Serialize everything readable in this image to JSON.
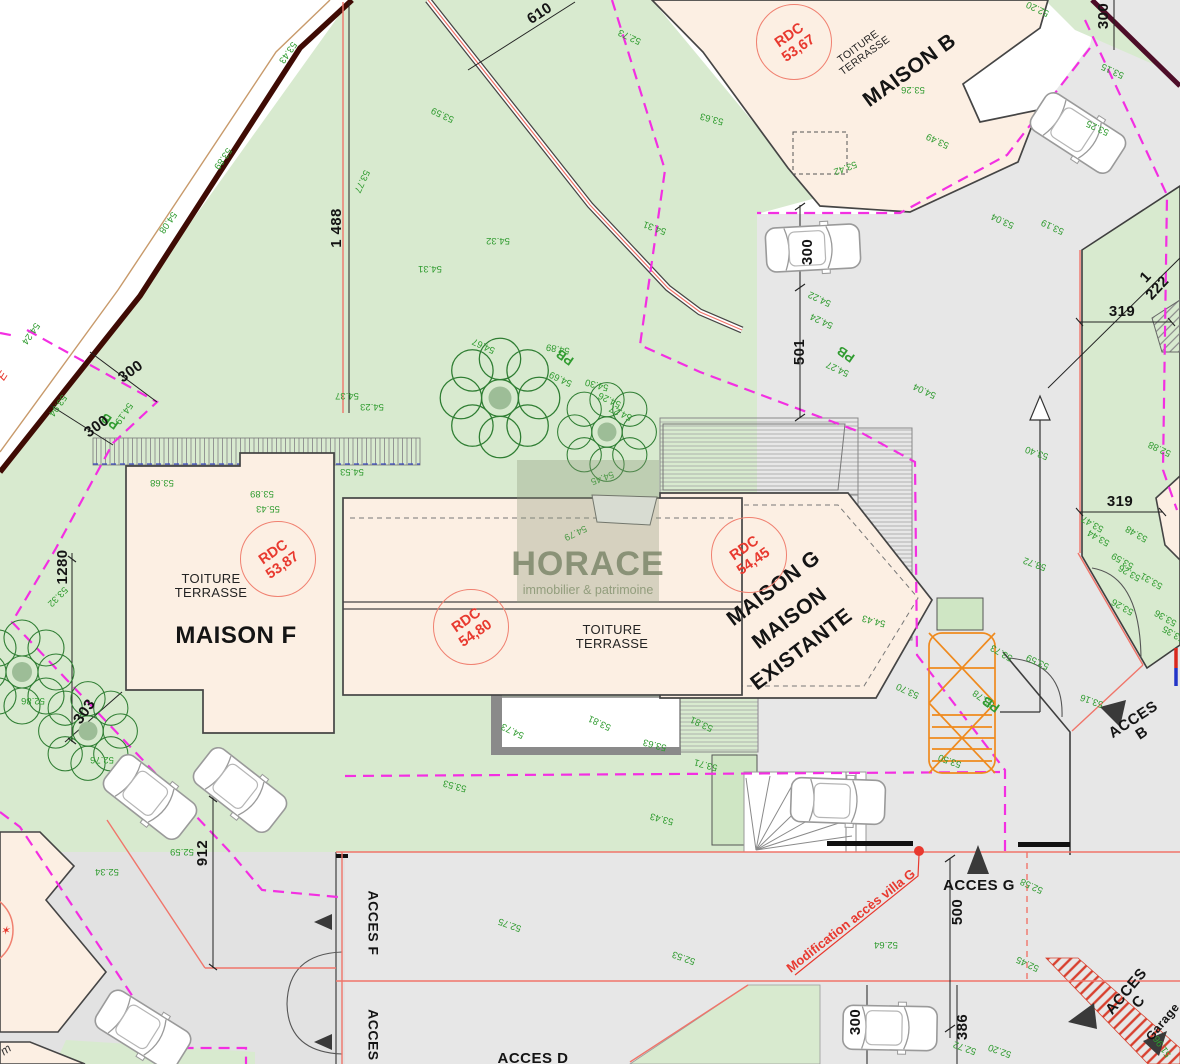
{
  "watermark": {
    "name": "HORACE",
    "tagline": "immobilier & patrimoine"
  },
  "colors": {
    "accent_red": "#e8392f",
    "elevation_green": "#2f9b2f",
    "limit_magenta": "#f32fe2",
    "boundary_dark": "#3f0b04",
    "watermark_olive": "#8d987c",
    "vehicle_orange": "#ef8a1e",
    "area_green": "#d8eacf",
    "area_gray": "#e7e7e7",
    "building_cream": "#fcefe3"
  },
  "buildings": [
    {
      "id": "maison-b",
      "label": "MAISON B",
      "roof": "TOITURE TERRASSE",
      "rdc": "53,67"
    },
    {
      "id": "maison-f",
      "label": "MAISON F",
      "roof": "TOITURE TERRASSE",
      "rdc": "53,87"
    },
    {
      "id": "maison-centre",
      "label": "",
      "roof": "TOITURE TERRASSE",
      "rdc": "54,80"
    },
    {
      "id": "maison-g",
      "label": "MAISON G MAISON EXISTANTE",
      "rdc": "54,45"
    }
  ],
  "annotations": {
    "rdc_circles": [
      {
        "label": "RDC",
        "value": "53,67",
        "x": 793,
        "y": 41
      },
      {
        "label": "RDC",
        "value": "53,87",
        "x": 277,
        "y": 558
      },
      {
        "label": "RDC",
        "value": "54,80",
        "x": 470,
        "y": 626
      },
      {
        "label": "RDC",
        "value": "54,45",
        "x": 748,
        "y": 554
      }
    ],
    "building_labels": [
      {
        "t": "MAISON B",
        "x": 910,
        "y": 71,
        "r": -36,
        "s": 21
      },
      {
        "t": "MAISON F",
        "x": 236,
        "y": 636,
        "r": 0,
        "s": 24
      },
      {
        "t": "MAISON G",
        "x": 774,
        "y": 589,
        "r": -37,
        "s": 21
      },
      {
        "t": "MAISON",
        "x": 790,
        "y": 619,
        "r": -37,
        "s": 21
      },
      {
        "t": "EXISTANTE",
        "x": 802,
        "y": 650,
        "r": -37,
        "s": 21
      }
    ],
    "roof_labels": [
      {
        "t": "TOITURE\nTERRASSE",
        "x": 862,
        "y": 52,
        "r": -36,
        "s": 10.5
      },
      {
        "t": "TOITURE\nTERRASSE",
        "x": 211,
        "y": 586,
        "r": 0,
        "s": 13
      },
      {
        "t": "TOITURE\nTERRASSE",
        "x": 612,
        "y": 637,
        "r": 0,
        "s": 13
      }
    ],
    "access_labels": [
      {
        "t": "ACCES F",
        "x": 373,
        "y": 923,
        "r": 90,
        "s": 14
      },
      {
        "t": "ACCES E",
        "x": 373,
        "y": 1042,
        "r": 90,
        "s": 14
      },
      {
        "t": "ACCES G",
        "x": 979,
        "y": 886,
        "r": 0,
        "s": 15
      },
      {
        "t": "ACCES B",
        "x": 1138,
        "y": 727,
        "r": -33,
        "s": 15
      },
      {
        "t": "ACCES C",
        "x": 1133,
        "y": 997,
        "r": -50,
        "s": 15
      },
      {
        "t": "ACCES D",
        "x": 533,
        "y": 1059,
        "r": 0,
        "s": 15
      },
      {
        "t": "Garage",
        "x": 1163,
        "y": 1022,
        "r": -50,
        "s": 12
      }
    ],
    "notes": [
      {
        "t": "Modification accès villa G",
        "x": 851,
        "y": 921,
        "r": -38
      }
    ],
    "dimensions": [
      {
        "t": "610",
        "x": 540,
        "y": 14,
        "r": -33
      },
      {
        "t": "1 488",
        "x": 337,
        "y": 228,
        "r": -90
      },
      {
        "t": "300",
        "x": 131,
        "y": 372,
        "r": -36
      },
      {
        "t": "300",
        "x": 97,
        "y": 427,
        "r": -36
      },
      {
        "t": "1280",
        "x": 63,
        "y": 567,
        "r": -90
      },
      {
        "t": "303",
        "x": 85,
        "y": 712,
        "r": -55
      },
      {
        "t": "912",
        "x": 203,
        "y": 853,
        "r": -90
      },
      {
        "t": "300",
        "x": 808,
        "y": 252,
        "r": -90
      },
      {
        "t": "501",
        "x": 800,
        "y": 352,
        "r": -90
      },
      {
        "t": "300",
        "x": 1104,
        "y": 16,
        "r": -90
      },
      {
        "t": "319",
        "x": 1122,
        "y": 312,
        "r": 0
      },
      {
        "t": "1 222",
        "x": 1152,
        "y": 283,
        "r": -47
      },
      {
        "t": "319",
        "x": 1120,
        "y": 502,
        "r": 0
      },
      {
        "t": "500",
        "x": 958,
        "y": 912,
        "r": -90
      },
      {
        "t": "300",
        "x": 856,
        "y": 1022,
        "r": -90
      },
      {
        "t": "386",
        "x": 963,
        "y": 1027,
        "r": -90
      }
    ],
    "pb_markers": [
      {
        "t": "PB",
        "x": 110,
        "y": 421,
        "r": 215
      },
      {
        "t": "PB",
        "x": 565,
        "y": 357,
        "r": 215
      },
      {
        "t": "PB",
        "x": 846,
        "y": 354,
        "r": 215
      },
      {
        "t": "PB",
        "x": 991,
        "y": 704,
        "r": 215
      }
    ],
    "green_elevations": [
      {
        "t": "52.20",
        "x": 1038,
        "y": 8,
        "r": 205
      },
      {
        "t": "52.73",
        "x": 630,
        "y": 36,
        "r": 205
      },
      {
        "t": "53.15",
        "x": 1113,
        "y": 70,
        "r": 205
      },
      {
        "t": "53.26",
        "x": 913,
        "y": 89,
        "r": 180
      },
      {
        "t": "53.63",
        "x": 712,
        "y": 118,
        "r": 195
      },
      {
        "t": "53.59",
        "x": 443,
        "y": 114,
        "r": 205
      },
      {
        "t": "53.25",
        "x": 1098,
        "y": 127,
        "r": 205
      },
      {
        "t": "53.49",
        "x": 938,
        "y": 140,
        "r": 205
      },
      {
        "t": "53.42",
        "x": 845,
        "y": 167,
        "r": 160
      },
      {
        "t": "53.04",
        "x": 1003,
        "y": 220,
        "r": 205
      },
      {
        "t": "53.19",
        "x": 1053,
        "y": 226,
        "r": 205
      },
      {
        "t": "53.43",
        "x": 287,
        "y": 52,
        "r": 125
      },
      {
        "t": "53.89",
        "x": 222,
        "y": 158,
        "r": 125
      },
      {
        "t": "54.08",
        "x": 167,
        "y": 222,
        "r": 125
      },
      {
        "t": "53.77",
        "x": 361,
        "y": 181,
        "r": 115
      },
      {
        "t": "54.24",
        "x": 30,
        "y": 333,
        "r": 125
      },
      {
        "t": "53.94",
        "x": 57,
        "y": 405,
        "r": 125
      },
      {
        "t": "54.19",
        "x": 123,
        "y": 413,
        "r": 125
      },
      {
        "t": "54.22",
        "x": 820,
        "y": 298,
        "r": 205
      },
      {
        "t": "54.24",
        "x": 822,
        "y": 320,
        "r": 205
      },
      {
        "t": "54.27",
        "x": 838,
        "y": 368,
        "r": 205
      },
      {
        "t": "54.04",
        "x": 925,
        "y": 390,
        "r": 205
      },
      {
        "t": "54.31",
        "x": 430,
        "y": 268,
        "r": 180
      },
      {
        "t": "54.32",
        "x": 498,
        "y": 240,
        "r": 180
      },
      {
        "t": "54.31",
        "x": 655,
        "y": 227,
        "r": 200
      },
      {
        "t": "54.23",
        "x": 372,
        "y": 406,
        "r": 180
      },
      {
        "t": "54.37",
        "x": 347,
        "y": 395,
        "r": 180
      },
      {
        "t": "54.67",
        "x": 484,
        "y": 345,
        "r": 205
      },
      {
        "t": "54.89",
        "x": 558,
        "y": 348,
        "r": 190
      },
      {
        "t": "54.69",
        "x": 561,
        "y": 378,
        "r": 205
      },
      {
        "t": "54.30",
        "x": 597,
        "y": 384,
        "r": 195
      },
      {
        "t": "54.26",
        "x": 610,
        "y": 399,
        "r": 205
      },
      {
        "t": "54.27",
        "x": 621,
        "y": 412,
        "r": 205
      },
      {
        "t": "54.45",
        "x": 602,
        "y": 477,
        "r": 160
      },
      {
        "t": "54.79",
        "x": 575,
        "y": 532,
        "r": 155
      },
      {
        "t": "54.53",
        "x": 352,
        "y": 471,
        "r": 180
      },
      {
        "t": "53.68",
        "x": 162,
        "y": 482,
        "r": 180
      },
      {
        "t": "53.89",
        "x": 262,
        "y": 493,
        "r": 180
      },
      {
        "t": "55.43",
        "x": 268,
        "y": 508,
        "r": 180
      },
      {
        "t": "53.32",
        "x": 57,
        "y": 596,
        "r": 135
      },
      {
        "t": "52.86",
        "x": 33,
        "y": 700,
        "r": 180
      },
      {
        "t": "52.76",
        "x": 102,
        "y": 759,
        "r": 180
      },
      {
        "t": "52.34",
        "x": 107,
        "y": 871,
        "r": 180
      },
      {
        "t": "52.59",
        "x": 182,
        "y": 851,
        "r": 180
      },
      {
        "t": "54.43",
        "x": 874,
        "y": 620,
        "r": 195
      },
      {
        "t": "53.70",
        "x": 908,
        "y": 690,
        "r": 205
      },
      {
        "t": "53.73",
        "x": 1002,
        "y": 652,
        "r": 210
      },
      {
        "t": "53.59",
        "x": 1038,
        "y": 661,
        "r": 205
      },
      {
        "t": "53.78",
        "x": 984,
        "y": 698,
        "r": 215
      },
      {
        "t": "53.50",
        "x": 950,
        "y": 760,
        "r": 200
      },
      {
        "t": "53.16",
        "x": 1092,
        "y": 700,
        "r": 200
      },
      {
        "t": "52.88",
        "x": 1160,
        "y": 448,
        "r": 205
      },
      {
        "t": "53.40",
        "x": 1037,
        "y": 452,
        "r": 200
      },
      {
        "t": "53.72",
        "x": 1035,
        "y": 563,
        "r": 200
      },
      {
        "t": "53.47",
        "x": 1093,
        "y": 523,
        "r": 210
      },
      {
        "t": "53.44",
        "x": 1099,
        "y": 537,
        "r": 210
      },
      {
        "t": "53.48",
        "x": 1137,
        "y": 533,
        "r": 210
      },
      {
        "t": "53.59",
        "x": 1123,
        "y": 560,
        "r": 210
      },
      {
        "t": "53.26",
        "x": 1130,
        "y": 572,
        "r": 210
      },
      {
        "t": "53.31",
        "x": 1152,
        "y": 580,
        "r": 210
      },
      {
        "t": "53.26",
        "x": 1123,
        "y": 606,
        "r": 210
      },
      {
        "t": "53.36",
        "x": 1166,
        "y": 617,
        "r": 210
      },
      {
        "t": "53.35",
        "x": 1174,
        "y": 633,
        "r": 210
      },
      {
        "t": "54.73",
        "x": 513,
        "y": 730,
        "r": 205
      },
      {
        "t": "53.81",
        "x": 600,
        "y": 722,
        "r": 205
      },
      {
        "t": "53.81",
        "x": 702,
        "y": 723,
        "r": 205
      },
      {
        "t": "53.71",
        "x": 706,
        "y": 764,
        "r": 195
      },
      {
        "t": "53.63",
        "x": 655,
        "y": 744,
        "r": 195
      },
      {
        "t": "53.43",
        "x": 662,
        "y": 818,
        "r": 195
      },
      {
        "t": "53.53",
        "x": 455,
        "y": 785,
        "r": 195
      },
      {
        "t": "52.75",
        "x": 510,
        "y": 924,
        "r": 200
      },
      {
        "t": "52.53",
        "x": 684,
        "y": 957,
        "r": 200
      },
      {
        "t": "52.64",
        "x": 886,
        "y": 944,
        "r": 180
      },
      {
        "t": "52.58",
        "x": 1032,
        "y": 885,
        "r": 205
      },
      {
        "t": "52.45",
        "x": 1028,
        "y": 963,
        "r": 205
      },
      {
        "t": "52.72",
        "x": 965,
        "y": 1047,
        "r": 200
      },
      {
        "t": "52.20",
        "x": 1000,
        "y": 1050,
        "r": 200
      },
      {
        "t": "51.96",
        "x": 1163,
        "y": 1046,
        "r": 235
      }
    ],
    "fragments": [
      {
        "t": "m",
        "x": 6,
        "y": 1050,
        "r": -35
      },
      {
        "t": "E",
        "x": 3,
        "y": 376,
        "r": -57,
        "col": "#e8392f"
      },
      {
        "t": "✶",
        "x": 5,
        "y": 931,
        "r": 0,
        "col": "#e8392f"
      }
    ]
  }
}
